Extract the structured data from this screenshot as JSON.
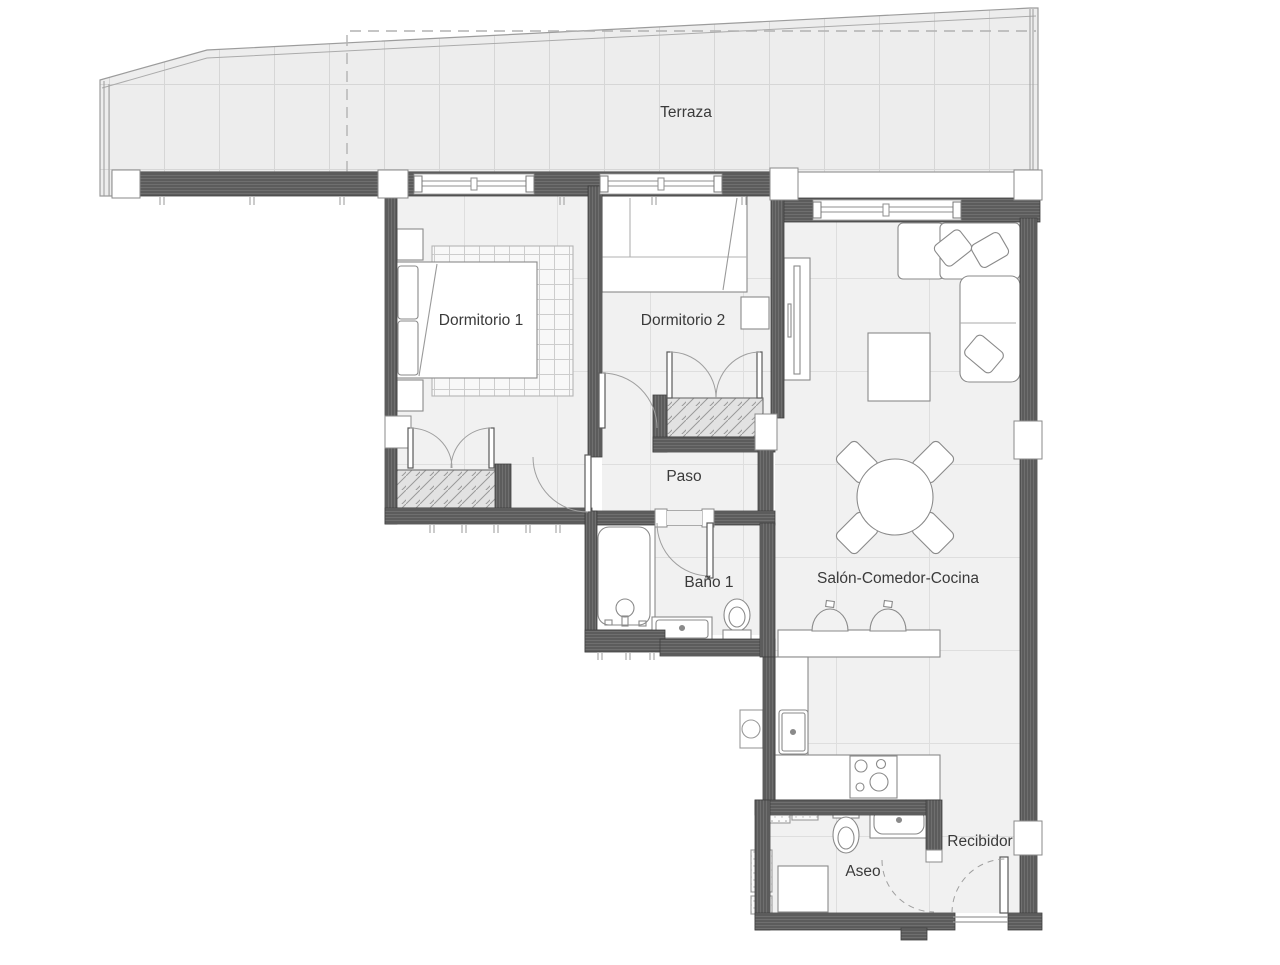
{
  "plan": {
    "type": "apartment-floor-plan",
    "rooms": [
      {
        "id": "terraza",
        "label": "Terraza"
      },
      {
        "id": "dormitorio-1",
        "label": "Dormitorio 1"
      },
      {
        "id": "dormitorio-2",
        "label": "Dormitorio 2"
      },
      {
        "id": "paso",
        "label": "Paso"
      },
      {
        "id": "bano-1",
        "label": "Baño 1"
      },
      {
        "id": "salon-comedor-cocina",
        "label": "Salón-Comedor-Cocina"
      },
      {
        "id": "aseo",
        "label": "Aseo"
      },
      {
        "id": "recibidor",
        "label": "Recibidor"
      }
    ],
    "colors": {
      "background": "#ffffff",
      "wall": "#5c5c5c",
      "wall_stripe": "#6f6f6f",
      "wall_outline": "#3f3f3f",
      "room_floor": "#f1f1f1",
      "terrace_floor": "#ededed",
      "grid_line": "#dedede",
      "terrace_grid_line": "#d6d6d6",
      "furniture_outline": "#8a8a8a",
      "hatch_fill": "#e2e2e2",
      "text": "#3a3a3a"
    }
  }
}
